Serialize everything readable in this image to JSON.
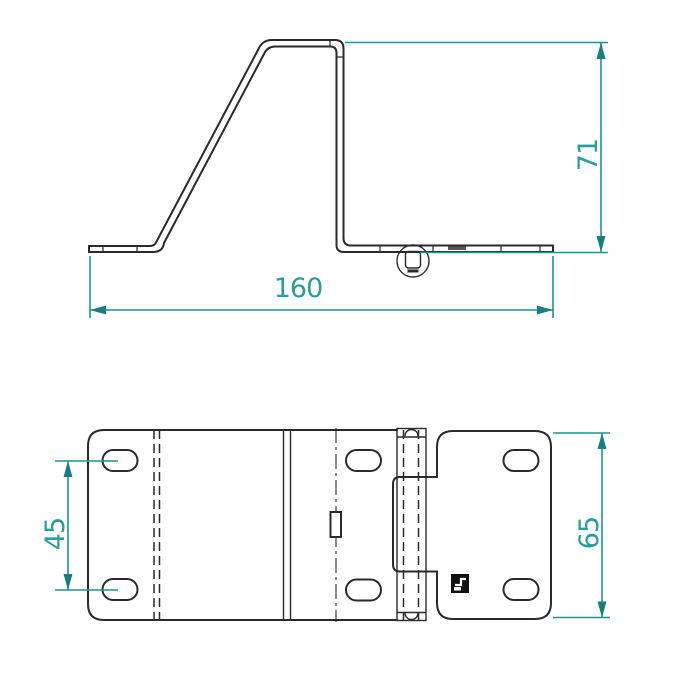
{
  "page": {
    "title": "bracket technical drawing",
    "background": "#ffffff"
  },
  "drawing": {
    "kind": "2-view sheet-metal bracket drawing",
    "line_color": "#2a2a2a",
    "dimension_color": "#1b9494",
    "views": [
      {
        "id": "side-profile-view",
        "dimensions": [
          "71",
          "160"
        ]
      },
      {
        "id": "plan-view",
        "dimensions": [
          "45",
          "65"
        ]
      }
    ]
  },
  "dims": {
    "profile_height": "71",
    "profile_width": "160",
    "hole_spacing": "45",
    "plate_height": "65"
  }
}
